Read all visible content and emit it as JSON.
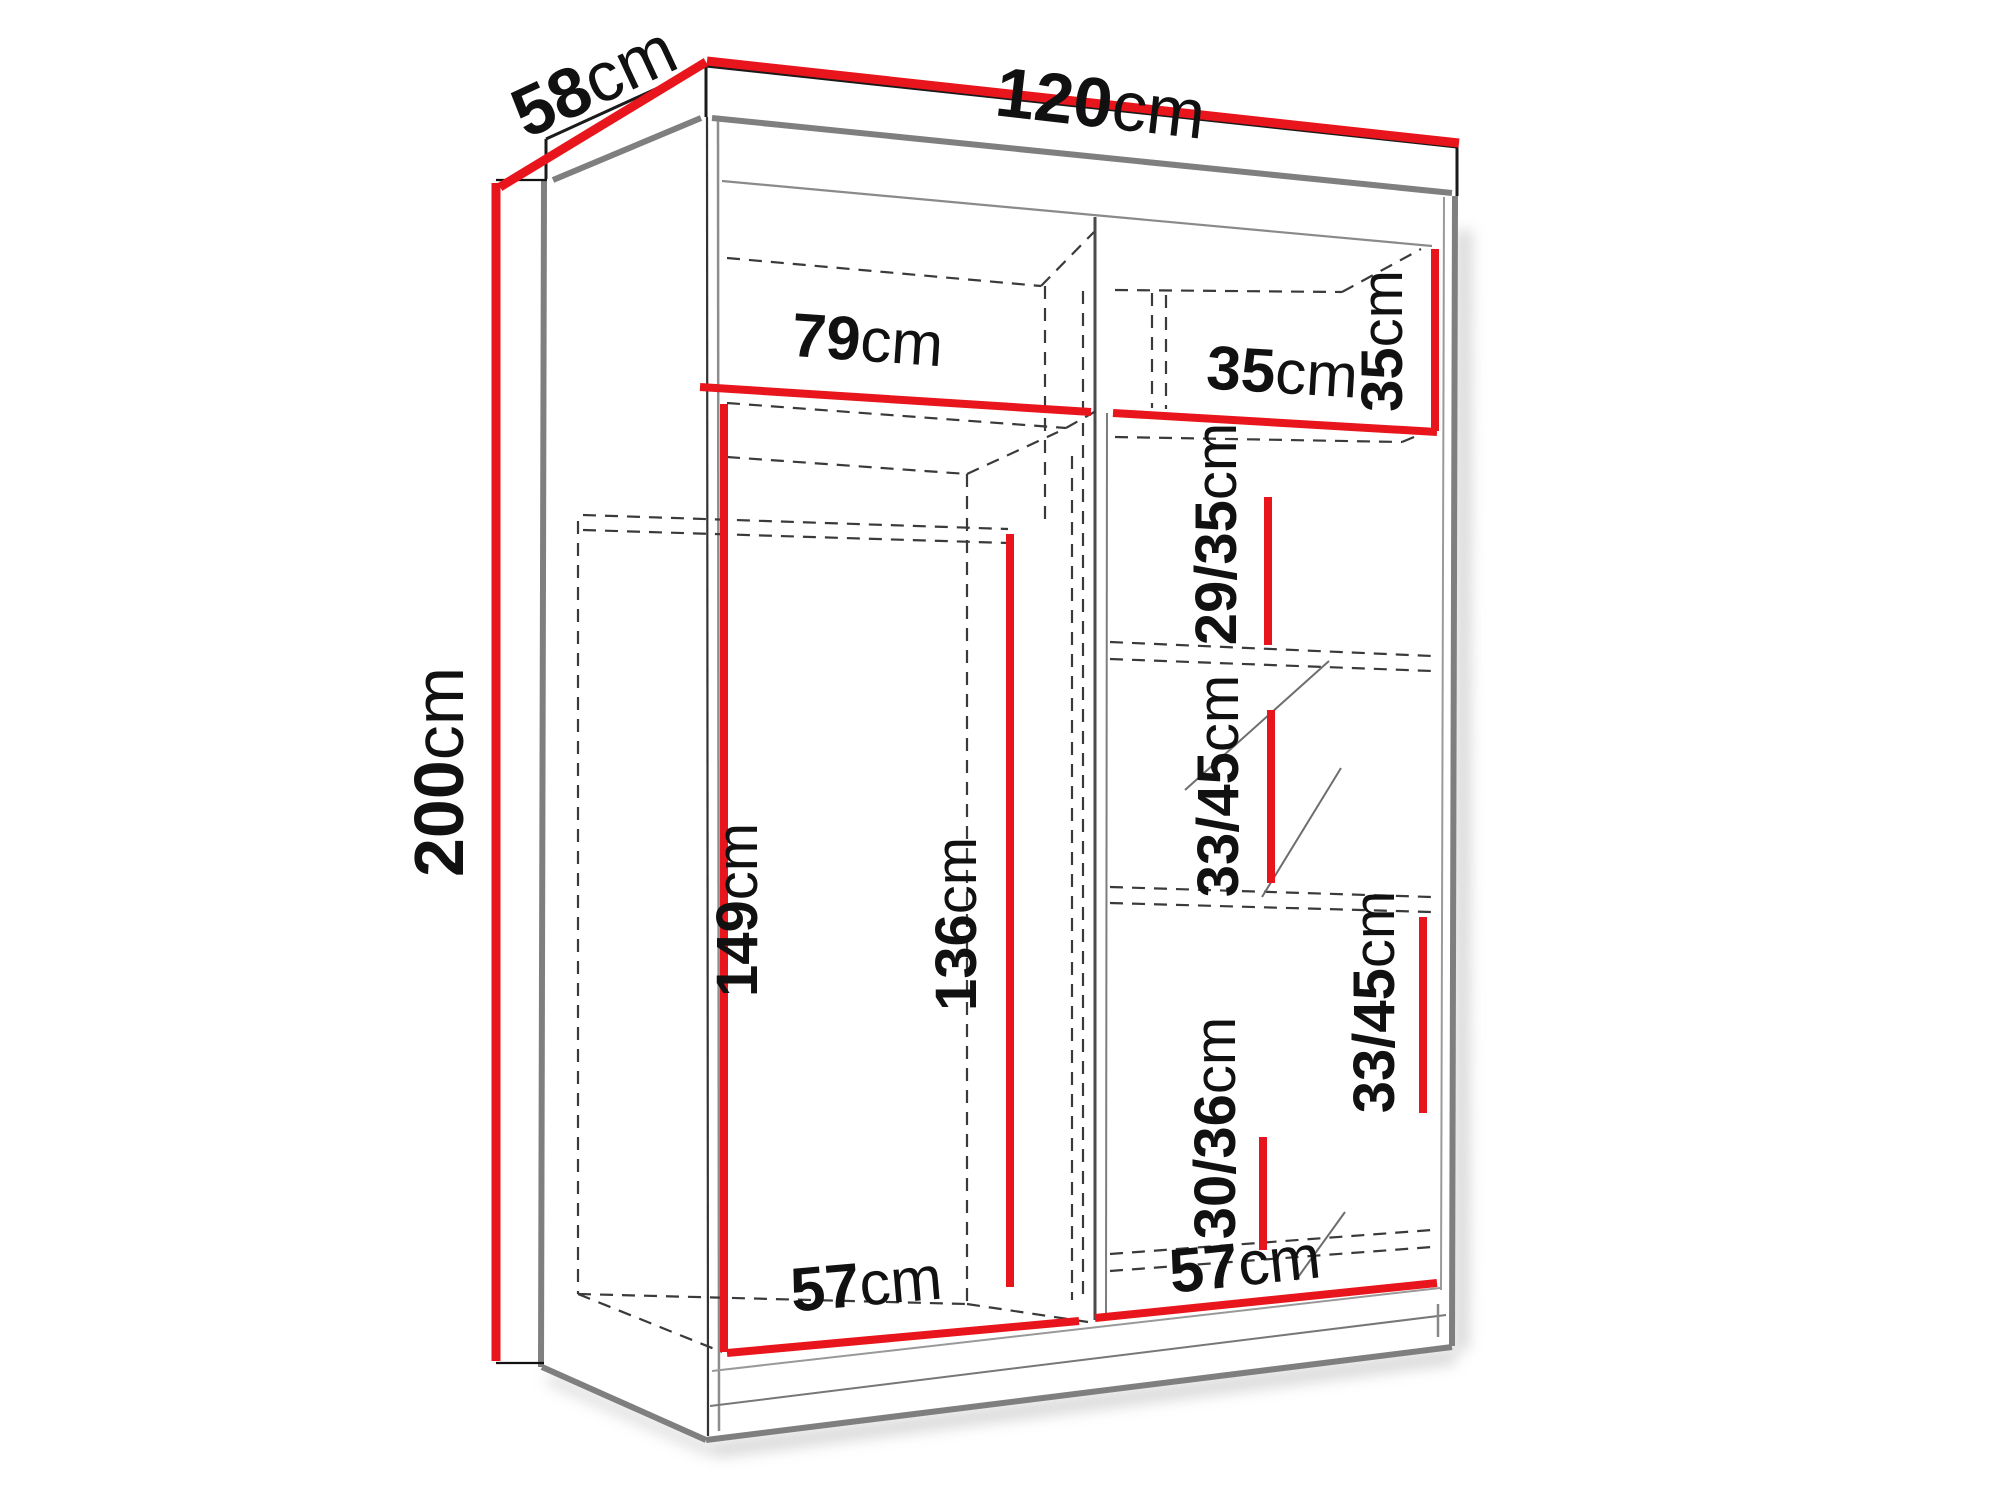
{
  "diagram": {
    "type": "wardrobe-dimension-drawing",
    "unit": "cm",
    "colors": {
      "dimension_line": "#e8151c",
      "outline": "#1a1a1a",
      "shading": "#7f7f7f",
      "background": "#ffffff"
    },
    "measurements": {
      "depth": {
        "value": "58",
        "unit": "cm"
      },
      "width": {
        "value": "120",
        "unit": "cm"
      },
      "height": {
        "value": "200",
        "unit": "cm"
      },
      "top_shelf_left": {
        "value": "79",
        "unit": "cm"
      },
      "top_shelf_right": {
        "value": "35",
        "unit": "cm"
      },
      "top_right_height": {
        "value": "35",
        "unit": "cm"
      },
      "gap_29_35": {
        "value": "29/35",
        "unit": "cm"
      },
      "gap_33_45_mid": {
        "value": "33/45",
        "unit": "cm"
      },
      "gap_33_45_right": {
        "value": "33/45",
        "unit": "cm"
      },
      "gap_30_36": {
        "value": "30/36",
        "unit": "cm"
      },
      "hanging_left": {
        "value": "149",
        "unit": "cm"
      },
      "hanging_right": {
        "value": "136",
        "unit": "cm"
      },
      "bottom_left": {
        "value": "57",
        "unit": "cm"
      },
      "bottom_right": {
        "value": "57",
        "unit": "cm"
      }
    }
  }
}
